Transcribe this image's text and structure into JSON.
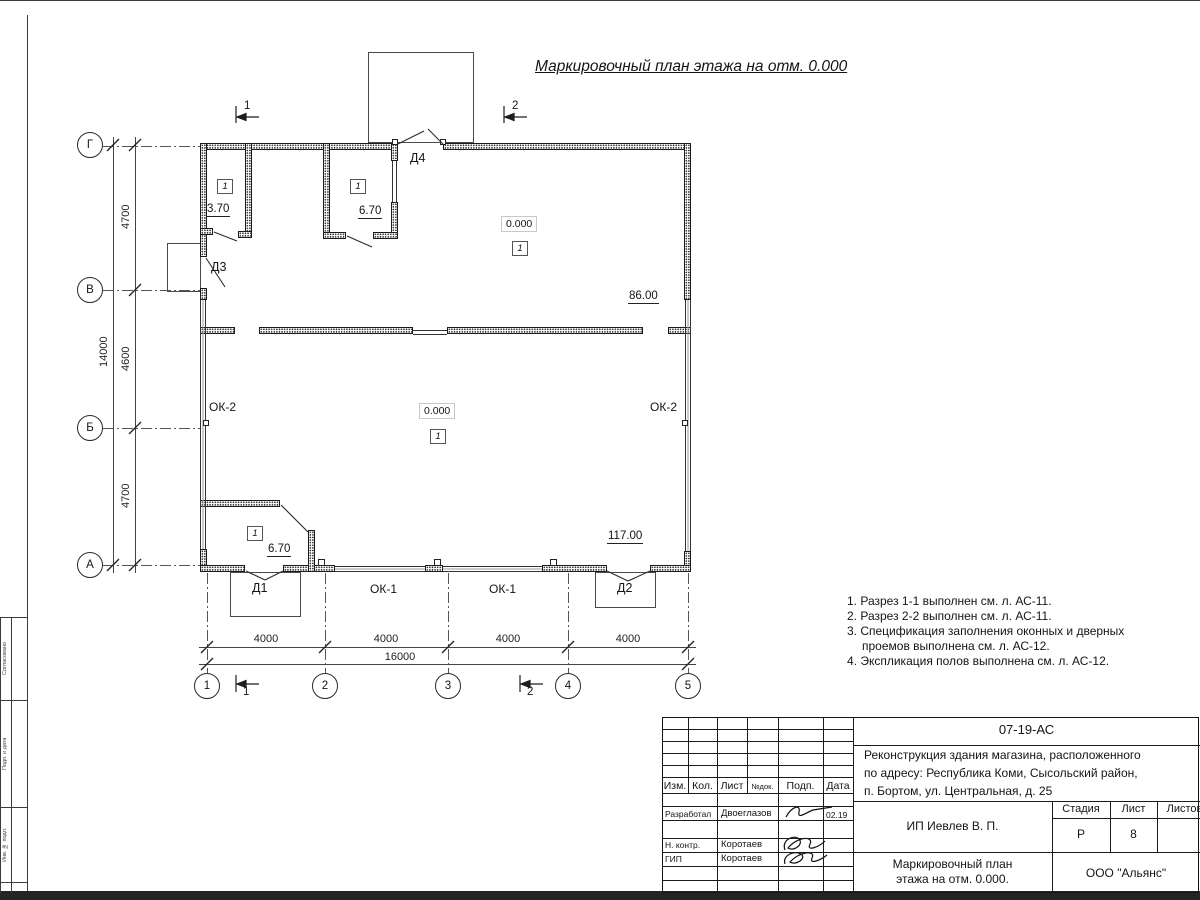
{
  "sheet": {
    "title": "Маркировочный план этажа на отм. 0.000",
    "notes": [
      "1. Разрез 1-1 выполнен см. л. АС-11.",
      "2. Разрез 2-2 выполнен см. л. АС-11.",
      "3. Спецификация заполнения оконных и дверных проемов выполнена см. л. АС-12.",
      "4. Экспликация полов выполнена см. л. АС-12."
    ]
  },
  "plan": {
    "row_axes": [
      "Г",
      "В",
      "Б",
      "А"
    ],
    "col_axes": [
      "1",
      "2",
      "3",
      "4",
      "5"
    ],
    "v_dims": [
      "4700",
      "4600",
      "4700"
    ],
    "v_total": "14000",
    "h_dims": [
      "4000",
      "4000",
      "4000",
      "4000"
    ],
    "h_total": "16000",
    "sections": [
      "1",
      "2"
    ],
    "floor_mark": "1",
    "elevation": "0.000",
    "labels": {
      "d1": "Д1",
      "d2": "Д2",
      "d3": "Д3",
      "d4": "Д4",
      "ok1": "ОК-1",
      "ok2": "ОК-2",
      "area_370": "3.70",
      "area_670": "6.70",
      "area_86": "86.00",
      "area_117": "117.00"
    }
  },
  "titleblock": {
    "doc_no": "07-19-АС",
    "project_line1": "Реконструкция здания магазина, расположенного",
    "project_line2": "по адресу: Республика Коми, Сысольский район,",
    "project_line3": "п. Бортом, ул. Центральная, д. 25",
    "client": "ИП Иевлев В. П.",
    "drawing_line1": "Маркировочный план",
    "drawing_line2": "этажа на отм. 0.000.",
    "org": "ООО \"Альянс\"",
    "stage_label": "Стадия",
    "sheet_label": "Лист",
    "sheets_label": "Листов",
    "stage": "Р",
    "sheet_no": "8",
    "cols": {
      "izm": "Изм.",
      "kol": "Кол.",
      "list": "Лист",
      "doc": "№док.",
      "podp": "Подп.",
      "data": "Дата"
    },
    "rows": {
      "r1_role": "Разработал",
      "r1_name": "Двоеглазов",
      "r1_date": "02.19",
      "r2_role": "Н. контр.",
      "r2_name": "Коротаев",
      "r3_role": "ГИП",
      "r3_name": "Коротаев"
    }
  },
  "frame": {
    "box1": "Согласовано",
    "box2": "Подп. и дата",
    "box3": "Инв. № подл."
  }
}
